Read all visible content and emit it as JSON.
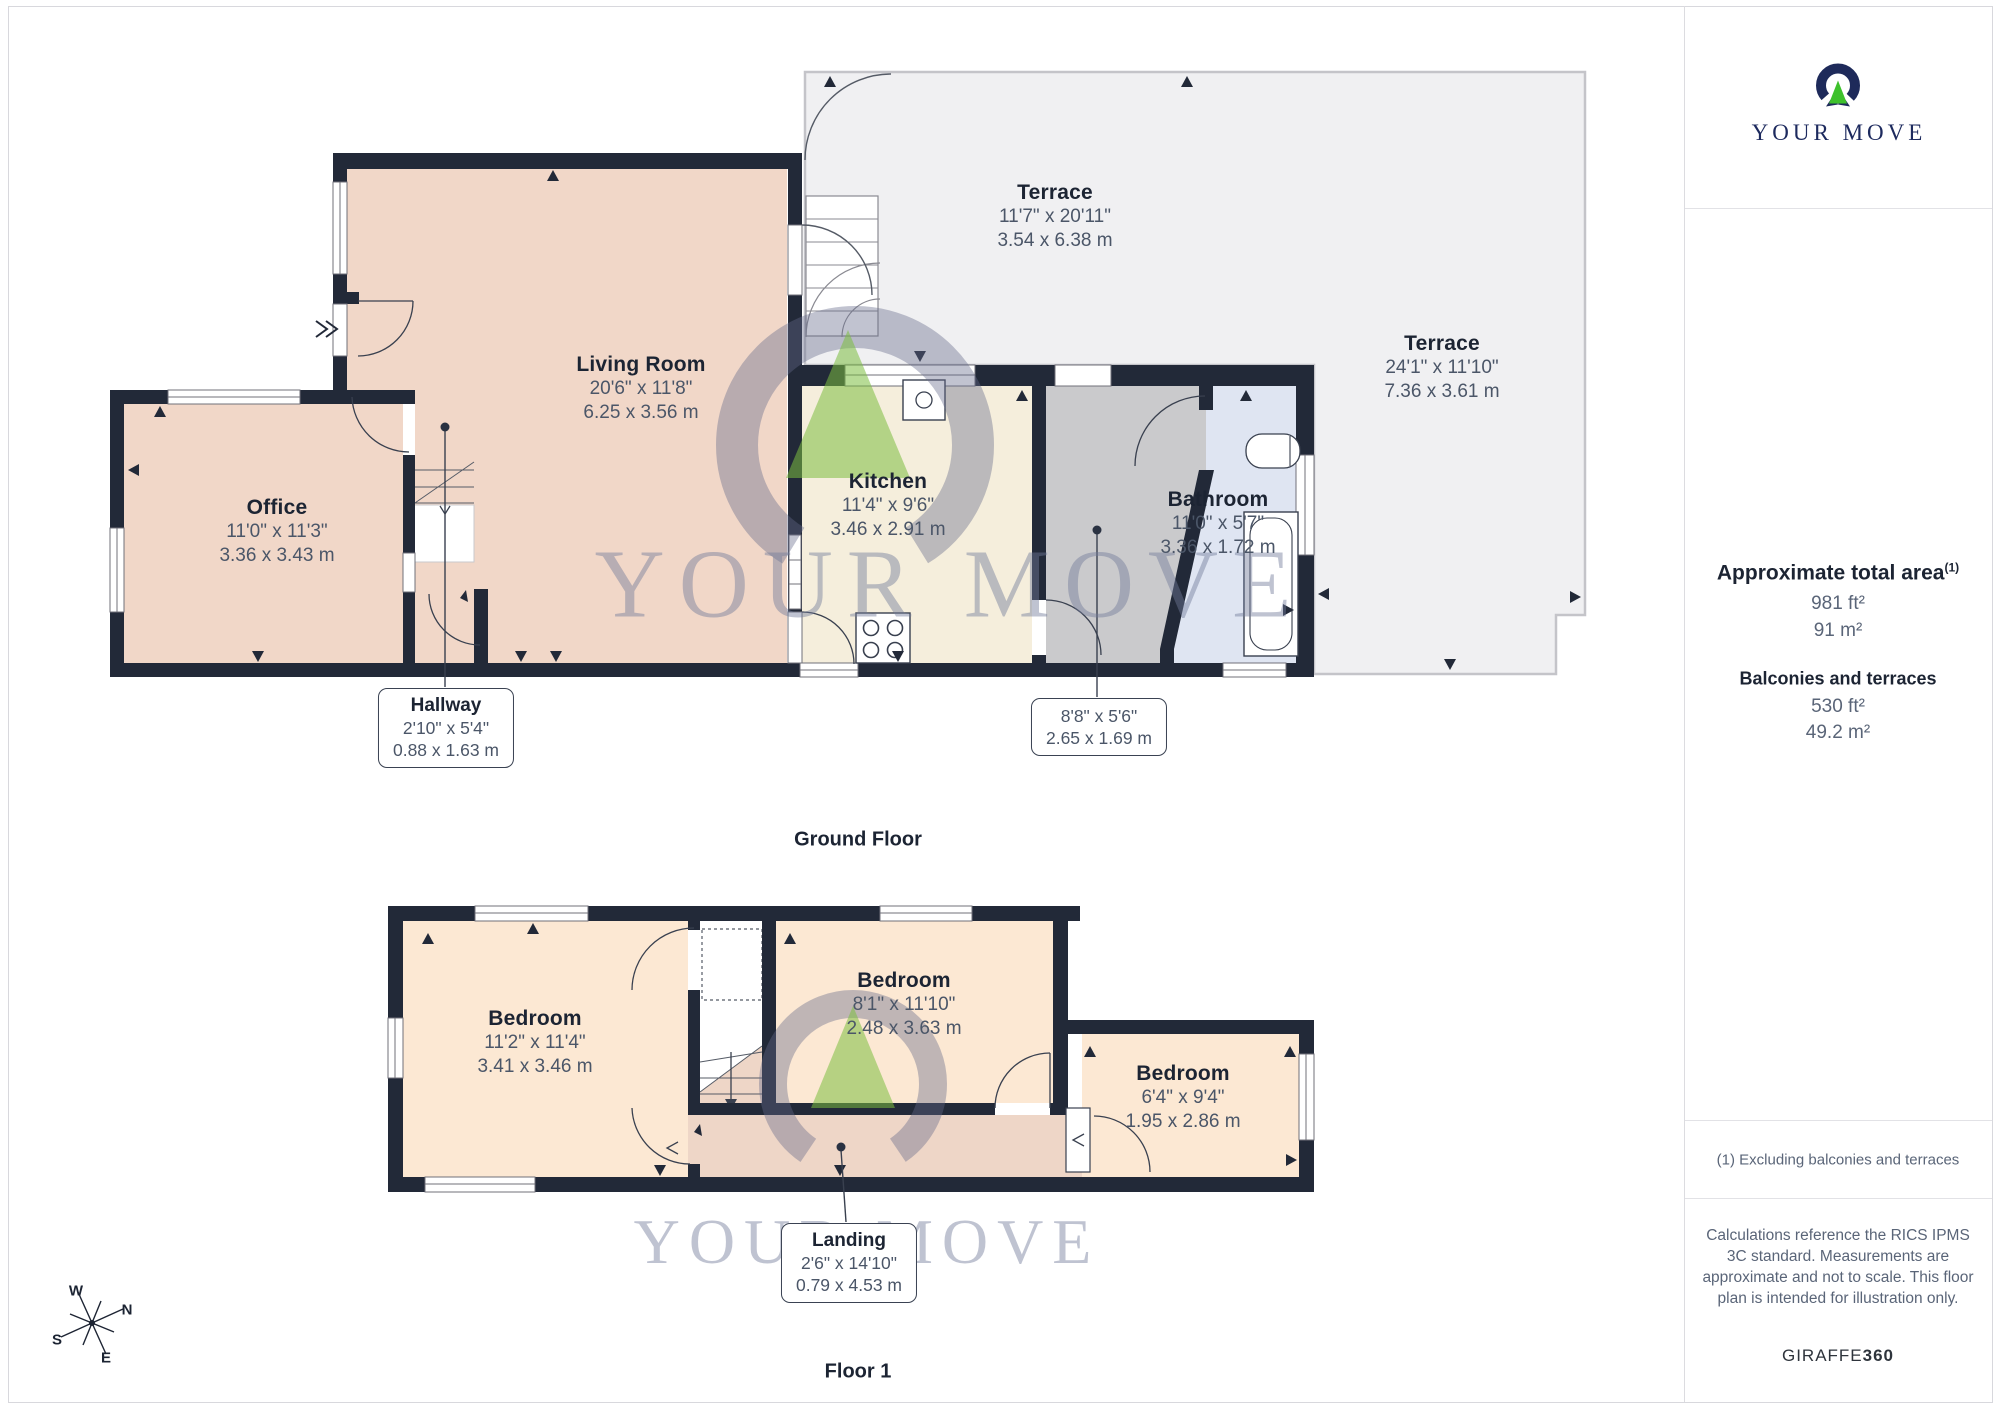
{
  "brand": {
    "logo_text": "YOUR MOVE"
  },
  "watermark": {
    "text": "YOUR MOVE"
  },
  "floors": [
    {
      "title": "Ground Floor"
    },
    {
      "title": "Floor 1"
    }
  ],
  "rooms": {
    "ground": [
      {
        "name": "Living Room",
        "imperial": "20'6\" x 11'8\"",
        "metric": "6.25 x 3.56 m"
      },
      {
        "name": "Office",
        "imperial": "11'0\" x 11'3\"",
        "metric": "3.36 x 3.43 m"
      },
      {
        "name": "Kitchen",
        "imperial": "11'4\" x 9'6\"",
        "metric": "3.46 x 2.91 m"
      },
      {
        "name": "Bathroom",
        "imperial": "11'0\" x 5'7\"",
        "metric": "3.36 x 1.72 m"
      },
      {
        "name": "Terrace",
        "imperial": "11'7\" x 20'11\"",
        "metric": "3.54 x 6.38 m"
      },
      {
        "name": "Terrace",
        "imperial": "24'1\" x 11'10\"",
        "metric": "7.36 x 3.61 m"
      }
    ],
    "floor1": [
      {
        "name": "Bedroom",
        "imperial": "11'2\" x 11'4\"",
        "metric": "3.41 x 3.46 m"
      },
      {
        "name": "Bedroom",
        "imperial": "8'1\" x 11'10\"",
        "metric": "2.48 x 3.63 m"
      },
      {
        "name": "Bedroom",
        "imperial": "6'4\" x 9'4\"",
        "metric": "1.95 x 2.86 m"
      }
    ]
  },
  "callouts": {
    "hallway": {
      "name": "Hallway",
      "imperial": "2'10\" x 5'4\"",
      "metric": "0.88 x 1.63 m"
    },
    "lobby": {
      "imperial": "8'8\" x 5'6\"",
      "metric": "2.65 x 1.69 m"
    },
    "landing": {
      "name": "Landing",
      "imperial": "2'6\" x 14'10\"",
      "metric": "0.79 x 4.53 m"
    }
  },
  "compass": {
    "n": "N",
    "s": "S",
    "e": "E",
    "w": "W"
  },
  "sidebar": {
    "total_area": {
      "heading": "Approximate total area",
      "superscript": "(1)",
      "value_ft": "981 ft²",
      "value_m": "91 m²"
    },
    "balconies": {
      "heading": "Balconies and terraces",
      "value_ft": "530 ft²",
      "value_m": "49.2 m²"
    },
    "footnote": "(1) Excluding balconies and terraces",
    "disclaimer": "Calculations reference the RICS IPMS 3C standard. Measurements are approximate and not to scale. This floor plan is intended for illustration only.",
    "credit_regular": "GIRAFFE",
    "credit_bold": "360"
  }
}
